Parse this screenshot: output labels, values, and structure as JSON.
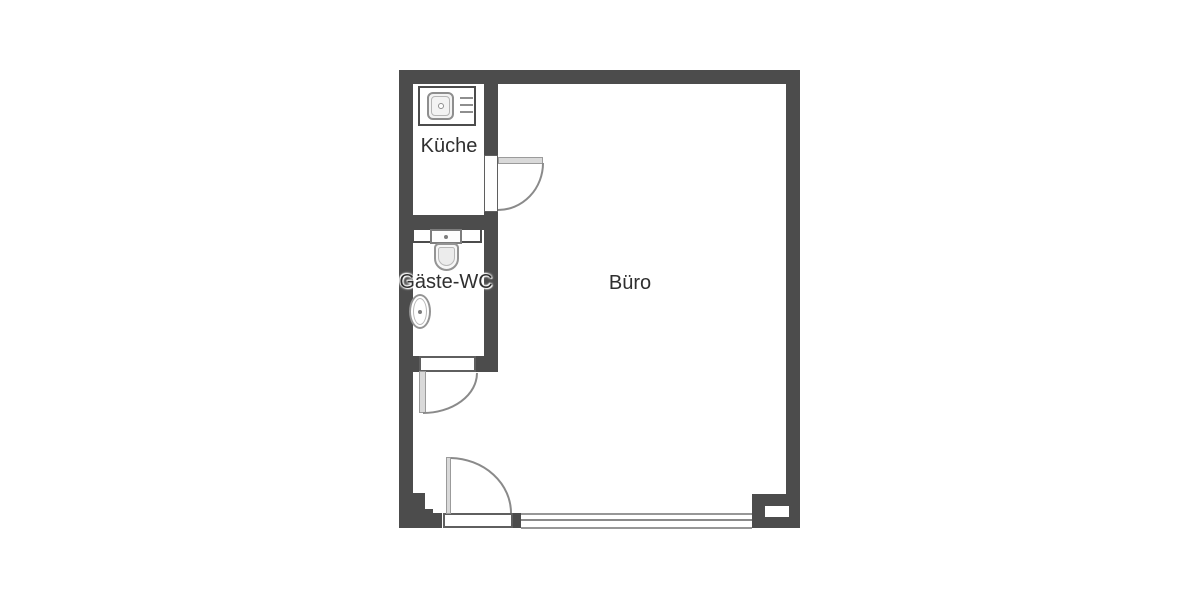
{
  "rooms": [
    {
      "id": "kueche",
      "label": "Küche"
    },
    {
      "id": "gaeste-wc",
      "label": "Gäste-WC"
    },
    {
      "id": "buero",
      "label": "Büro"
    }
  ],
  "fixtures": [
    {
      "icon": "kitchen-sink-icon",
      "room": "Küche"
    },
    {
      "icon": "toilet-icon",
      "room": "Gäste-WC"
    },
    {
      "icon": "wash-basin-icon",
      "room": "Gäste-WC"
    },
    {
      "icon": "door-swing-icon",
      "room": "Küche"
    },
    {
      "icon": "door-swing-icon",
      "room": "Gäste-WC"
    },
    {
      "icon": "door-swing-icon",
      "room": "Büro"
    },
    {
      "icon": "window-glazing-icon",
      "room": "Büro"
    }
  ],
  "colors": {
    "background": "#ffffff",
    "wall": "#4c4c4c",
    "fixture_outline": "#8e8e8e",
    "door_leaf": "#d9d9d9",
    "door_arc": "#8a8a8a",
    "label_text": "#2f2f2f"
  }
}
